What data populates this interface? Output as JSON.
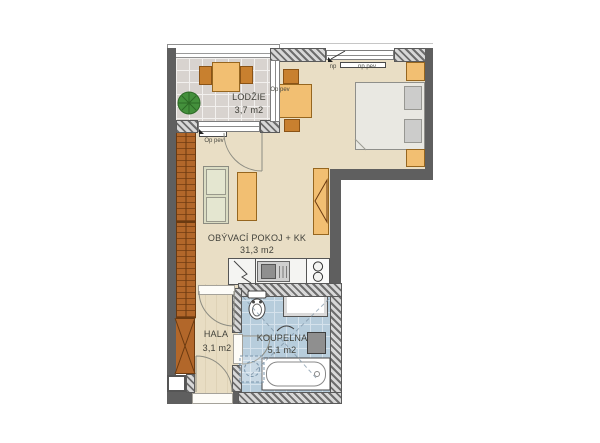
{
  "rooms": [
    {
      "name": "LODŽIE",
      "area": "3,7 m2"
    },
    {
      "name": "OBÝVACÍ POKOJ + KK",
      "area": "31,3 m2"
    },
    {
      "name": "HALA",
      "area": "3,1 m2"
    },
    {
      "name": "KOUPELNA",
      "area": "5,1 m2"
    }
  ],
  "ann": {
    "np": "np",
    "np_pev": "np pev",
    "op_pev_window": "Op pev",
    "op_pev_table": "Op pev"
  },
  "colors": {
    "wall": "#5f5f5f",
    "floor_living": "#e9dec5",
    "floor_loggia": "#d8d3cf",
    "floor_bath": "#b7cddc",
    "floor_hall": "#e8ddc3",
    "furniture_light": "#f2bf72",
    "furniture_dark": "#c8802f",
    "wardrobe": "#b2672a",
    "sofa": "#dadcc3",
    "bed": "#e9e8e2",
    "plant": "#44903c"
  }
}
